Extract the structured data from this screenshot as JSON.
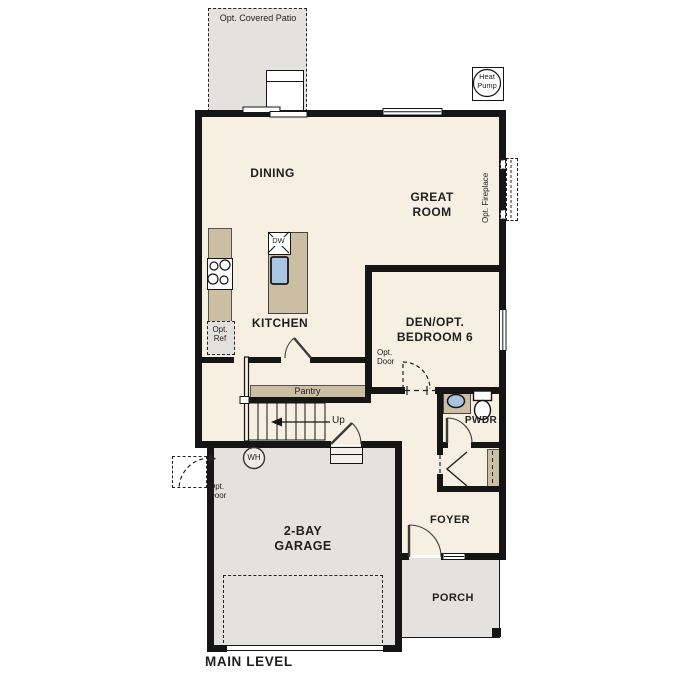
{
  "title": "MAIN LEVEL",
  "colors": {
    "wall": "#151515",
    "cream": "#f6efe2",
    "gray": "#e3e2df",
    "tan": "#ccbea2",
    "blue": "#a9c5e1"
  },
  "rooms": {
    "dining": "DINING",
    "great_room": "GREAT ROOM",
    "kitchen": "KITCHEN",
    "den": "DEN/OPT. BEDROOM 6",
    "pwdr": "PWDR",
    "foyer": "FOYER",
    "garage": "2-BAY GARAGE",
    "porch": "PORCH",
    "pantry": "Pantry"
  },
  "annotations": {
    "covered_patio": "Opt. Covered Patio",
    "heat_pump": "Heat Pump",
    "opt_fireplace": "Opt. Fireplace",
    "opt_ref": "Opt. Ref",
    "opt_door": "Opt. Door",
    "dishwasher": "DW",
    "water_heater": "WH",
    "stairs_up": "Up"
  }
}
